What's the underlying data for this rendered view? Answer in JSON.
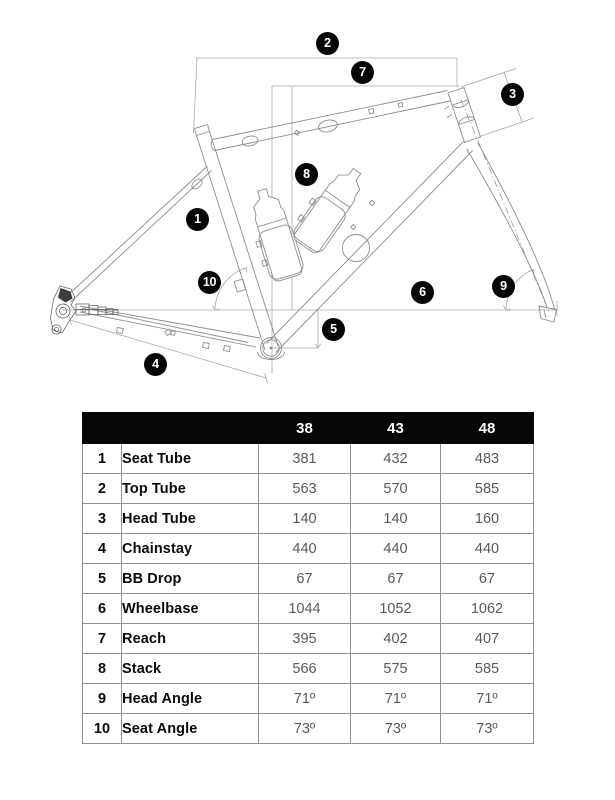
{
  "diagram": {
    "description": "Bicycle frame geometry line drawing with numbered measurement callouts",
    "callouts": [
      {
        "label": "1",
        "measure": "Seat Tube"
      },
      {
        "label": "2",
        "measure": "Top Tube"
      },
      {
        "label": "3",
        "measure": "Head Tube"
      },
      {
        "label": "4",
        "measure": "Chainstay"
      },
      {
        "label": "5",
        "measure": "BB Drop"
      },
      {
        "label": "6",
        "measure": "Wheelbase"
      },
      {
        "label": "7",
        "measure": "Reach"
      },
      {
        "label": "8",
        "measure": "Stack"
      },
      {
        "label": "9",
        "measure": "Head Angle"
      },
      {
        "label": "10",
        "measure": "Seat Angle"
      }
    ]
  },
  "table": {
    "size_headers": [
      "38",
      "43",
      "48"
    ],
    "rows": [
      {
        "num": "1",
        "name": "Seat Tube",
        "values": [
          "381",
          "432",
          "483"
        ]
      },
      {
        "num": "2",
        "name": "Top Tube",
        "values": [
          "563",
          "570",
          "585"
        ]
      },
      {
        "num": "3",
        "name": "Head Tube",
        "values": [
          "140",
          "140",
          "160"
        ]
      },
      {
        "num": "4",
        "name": "Chainstay",
        "values": [
          "440",
          "440",
          "440"
        ]
      },
      {
        "num": "5",
        "name": "BB Drop",
        "values": [
          "67",
          "67",
          "67"
        ]
      },
      {
        "num": "6",
        "name": "Wheelbase",
        "values": [
          "1044",
          "1052",
          "1062"
        ]
      },
      {
        "num": "7",
        "name": "Reach",
        "values": [
          "395",
          "402",
          "407"
        ]
      },
      {
        "num": "8",
        "name": "Stack",
        "values": [
          "566",
          "575",
          "585"
        ]
      },
      {
        "num": "9",
        "name": "Head Angle",
        "values": [
          "71º",
          "71º",
          "71º"
        ]
      },
      {
        "num": "10",
        "name": "Seat Angle",
        "values": [
          "73º",
          "73º",
          "73º"
        ]
      }
    ]
  },
  "colors": {
    "header_bg": "#060606",
    "header_text": "#ffffff",
    "value_text": "#58595b",
    "table_border": "#8f9193",
    "frame_line": "#8e8e8e",
    "dimension_line": "#a8a8a8"
  }
}
